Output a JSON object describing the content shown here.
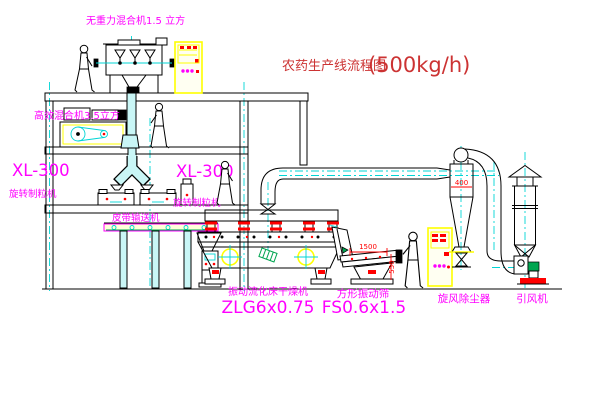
{
  "title": {
    "name_cn": "农药生产线流程图",
    "capacity": "(500kg/h)"
  },
  "labels": {
    "gravity_mixer": "无重力混合机1.5 立方",
    "high_eff_mixer": "高效混合机3.5立方",
    "granulator_left_model": "XL-300",
    "granulator_left_name": "旋转制粒机",
    "granulator_mid_model": "XL-300",
    "granulator_mid_name": "旋转制粒机",
    "belt_conveyor": "皮带输送机",
    "dryer_name": "振动流化床干燥机",
    "dryer_model": "ZLG6x0.75",
    "screen_name": "方形振动筛",
    "screen_model": "FS0.6x1.5",
    "cyclone_name": "旋风除尘器",
    "fan_name": "引风机"
  },
  "dimensions": {
    "cyclone_width": "400",
    "screen_length": "1500",
    "screen_height": "550"
  },
  "colors": {
    "line": "#000000",
    "label": "#ff00ff",
    "title": "#cc3333",
    "centerline": "#00d5d5",
    "pipe_fill": "#c9f6f6",
    "cabinet": "#ffff00",
    "accent_red": "#ff0000",
    "accent_green": "#00a550"
  }
}
